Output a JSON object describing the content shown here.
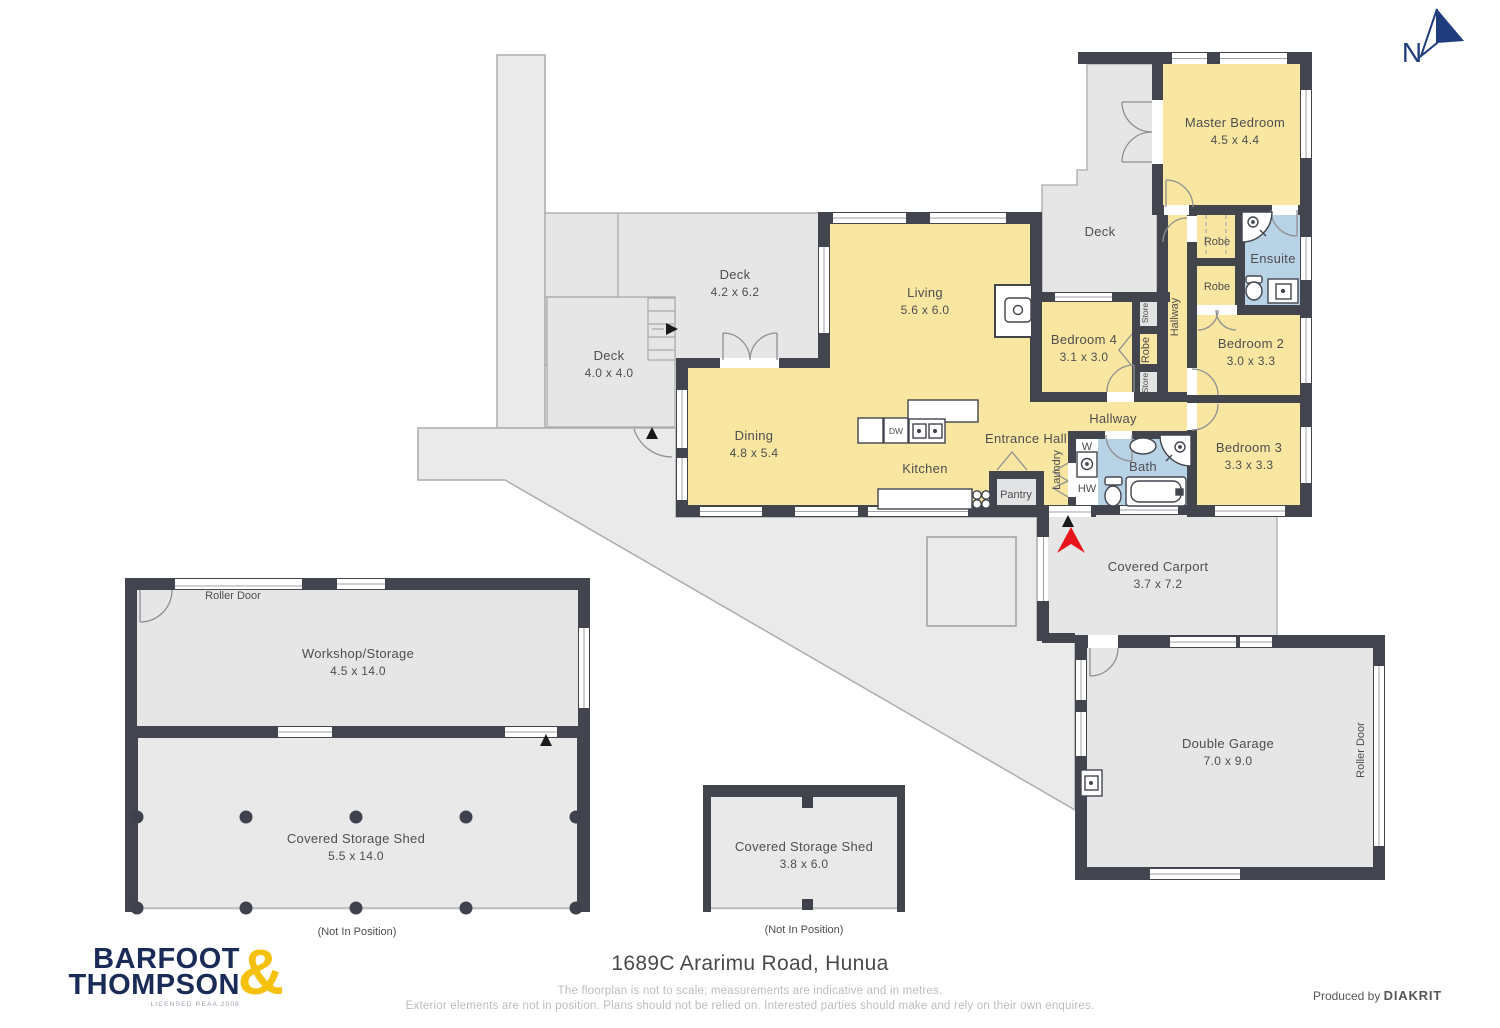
{
  "plan": {
    "north_label": "N",
    "rooms": {
      "master": {
        "name": "Master Bedroom",
        "dims": "4.5 x 4.4"
      },
      "deck_master": {
        "name": "Deck"
      },
      "robe_top": {
        "name": "Robe"
      },
      "ensuite": {
        "name": "Ensuite"
      },
      "robe_mid": {
        "name": "Robe"
      },
      "hallway_vert": {
        "name": "Hallway"
      },
      "bedroom2": {
        "name": "Bedroom 2",
        "dims": "3.0 x 3.3"
      },
      "bedroom3": {
        "name": "Bedroom 3",
        "dims": "3.3 x 3.3"
      },
      "bedroom4": {
        "name": "Bedroom 4",
        "dims": "3.1 x 3.0"
      },
      "store_top": {
        "name": "Store"
      },
      "robe_col": {
        "name": "Robe"
      },
      "store_bottom": {
        "name": "Store"
      },
      "living": {
        "name": "Living",
        "dims": "5.6 x 6.0"
      },
      "deck_upper": {
        "name": "Deck",
        "dims": "4.2 x 6.2"
      },
      "deck_lower": {
        "name": "Deck",
        "dims": "4.0 x 4.0"
      },
      "dining": {
        "name": "Dining",
        "dims": "4.8 x 5.4"
      },
      "kitchen": {
        "name": "Kitchen"
      },
      "dw": {
        "name": "DW"
      },
      "entrance": {
        "name": "Entrance Hall"
      },
      "laundry": {
        "name": "Laundry"
      },
      "w": {
        "name": "W"
      },
      "hw": {
        "name": "HW"
      },
      "bath": {
        "name": "Bath"
      },
      "hallway": {
        "name": "Hallway"
      },
      "pantry": {
        "name": "Pantry"
      },
      "carport": {
        "name": "Covered Carport",
        "dims": "3.7 x 7.2"
      },
      "garage": {
        "name": "Double Garage",
        "dims": "7.0 x 9.0"
      },
      "roller_garage": {
        "name": "Roller Door"
      },
      "roller_workshop": {
        "name": "Roller Door"
      },
      "workshop": {
        "name": "Workshop/Storage",
        "dims": "4.5 x 14.0"
      },
      "shed_large": {
        "name": "Covered Storage Shed",
        "dims": "5.5 x 14.0",
        "note": "(Not In Position)"
      },
      "shed_small": {
        "name": "Covered Storage Shed",
        "dims": "3.8 x 6.0",
        "note": "(Not In Position)"
      }
    },
    "colors": {
      "room_yellow": "#F9E7A1",
      "deck_gray": "#E6E6E7",
      "driveway_gray": "#EAEAEB",
      "wet_blue": "#B9D3E6",
      "wall_dark": "#42454E",
      "entry_red": "#E8141C",
      "north_navy": "#1F3D7C",
      "logo_navy": "#1B2B57",
      "logo_yellow": "#F4C20D"
    }
  },
  "footer": {
    "address": "1689C Ararimu Road, Hunua",
    "disclaimer1": "The floorplan is not to scale; measurements are indicative and in metres.",
    "disclaimer2": "Exterior elements are not in position. Plans should not be relied on. Interested parties should make and rely on their own enquires.",
    "produced_by": "Produced by",
    "producer": "DIAKRIT",
    "logo_line1": "BARFOOT",
    "logo_line2": "THOMPSON",
    "logo_amp": "&",
    "logo_license": "LICENSED REAA 2008"
  }
}
